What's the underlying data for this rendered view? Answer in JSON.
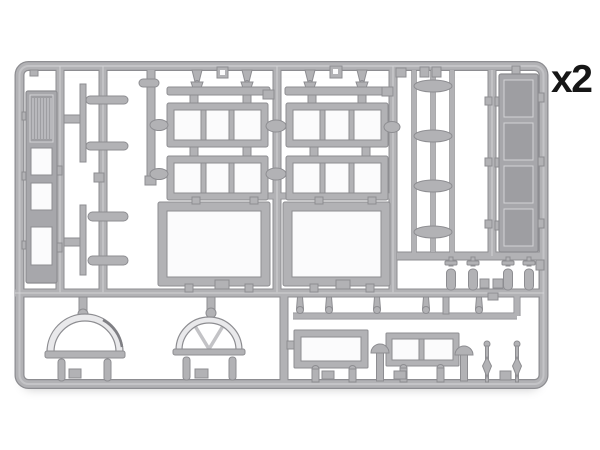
{
  "annotation": {
    "quantity_label": "x2"
  },
  "theme": {
    "page_bg": "#ffffff",
    "sprue_fill": "#b2b2b5",
    "sprue_edge": "#8d8d91",
    "sprue_light": "#d3d3d6",
    "sprue_dark": "#9a9a9e",
    "panel_fill": "#a7a7ab",
    "panel_inner": "#9e9ea2",
    "open_fill": "#fbfbfc",
    "ring_fill": "#e9e9eb",
    "label_color": "#161616"
  },
  "sprue": {
    "description": "grey styrene model-kit sprue with building parts",
    "parts": [
      {
        "name": "louvered-door-frame",
        "count": 1
      },
      {
        "name": "four-panel-door",
        "count": 1
      },
      {
        "name": "three-pane-window",
        "count": 4
      },
      {
        "name": "large-open-frame",
        "count": 2
      },
      {
        "name": "single-pane-window",
        "count": 1
      },
      {
        "name": "two-pane-window",
        "count": 1
      },
      {
        "name": "plain-arched-fanlight",
        "count": 1
      },
      {
        "name": "spoked-arched-fanlight",
        "count": 1
      },
      {
        "name": "chimney-pot",
        "count": 4
      },
      {
        "name": "finial-pin",
        "count": 2
      },
      {
        "name": "mushroom-pin",
        "count": 2
      },
      {
        "name": "sill-bar",
        "count": 5
      },
      {
        "name": "flat-strip",
        "count": 2
      },
      {
        "name": "lens-bar",
        "count": 4
      }
    ]
  }
}
